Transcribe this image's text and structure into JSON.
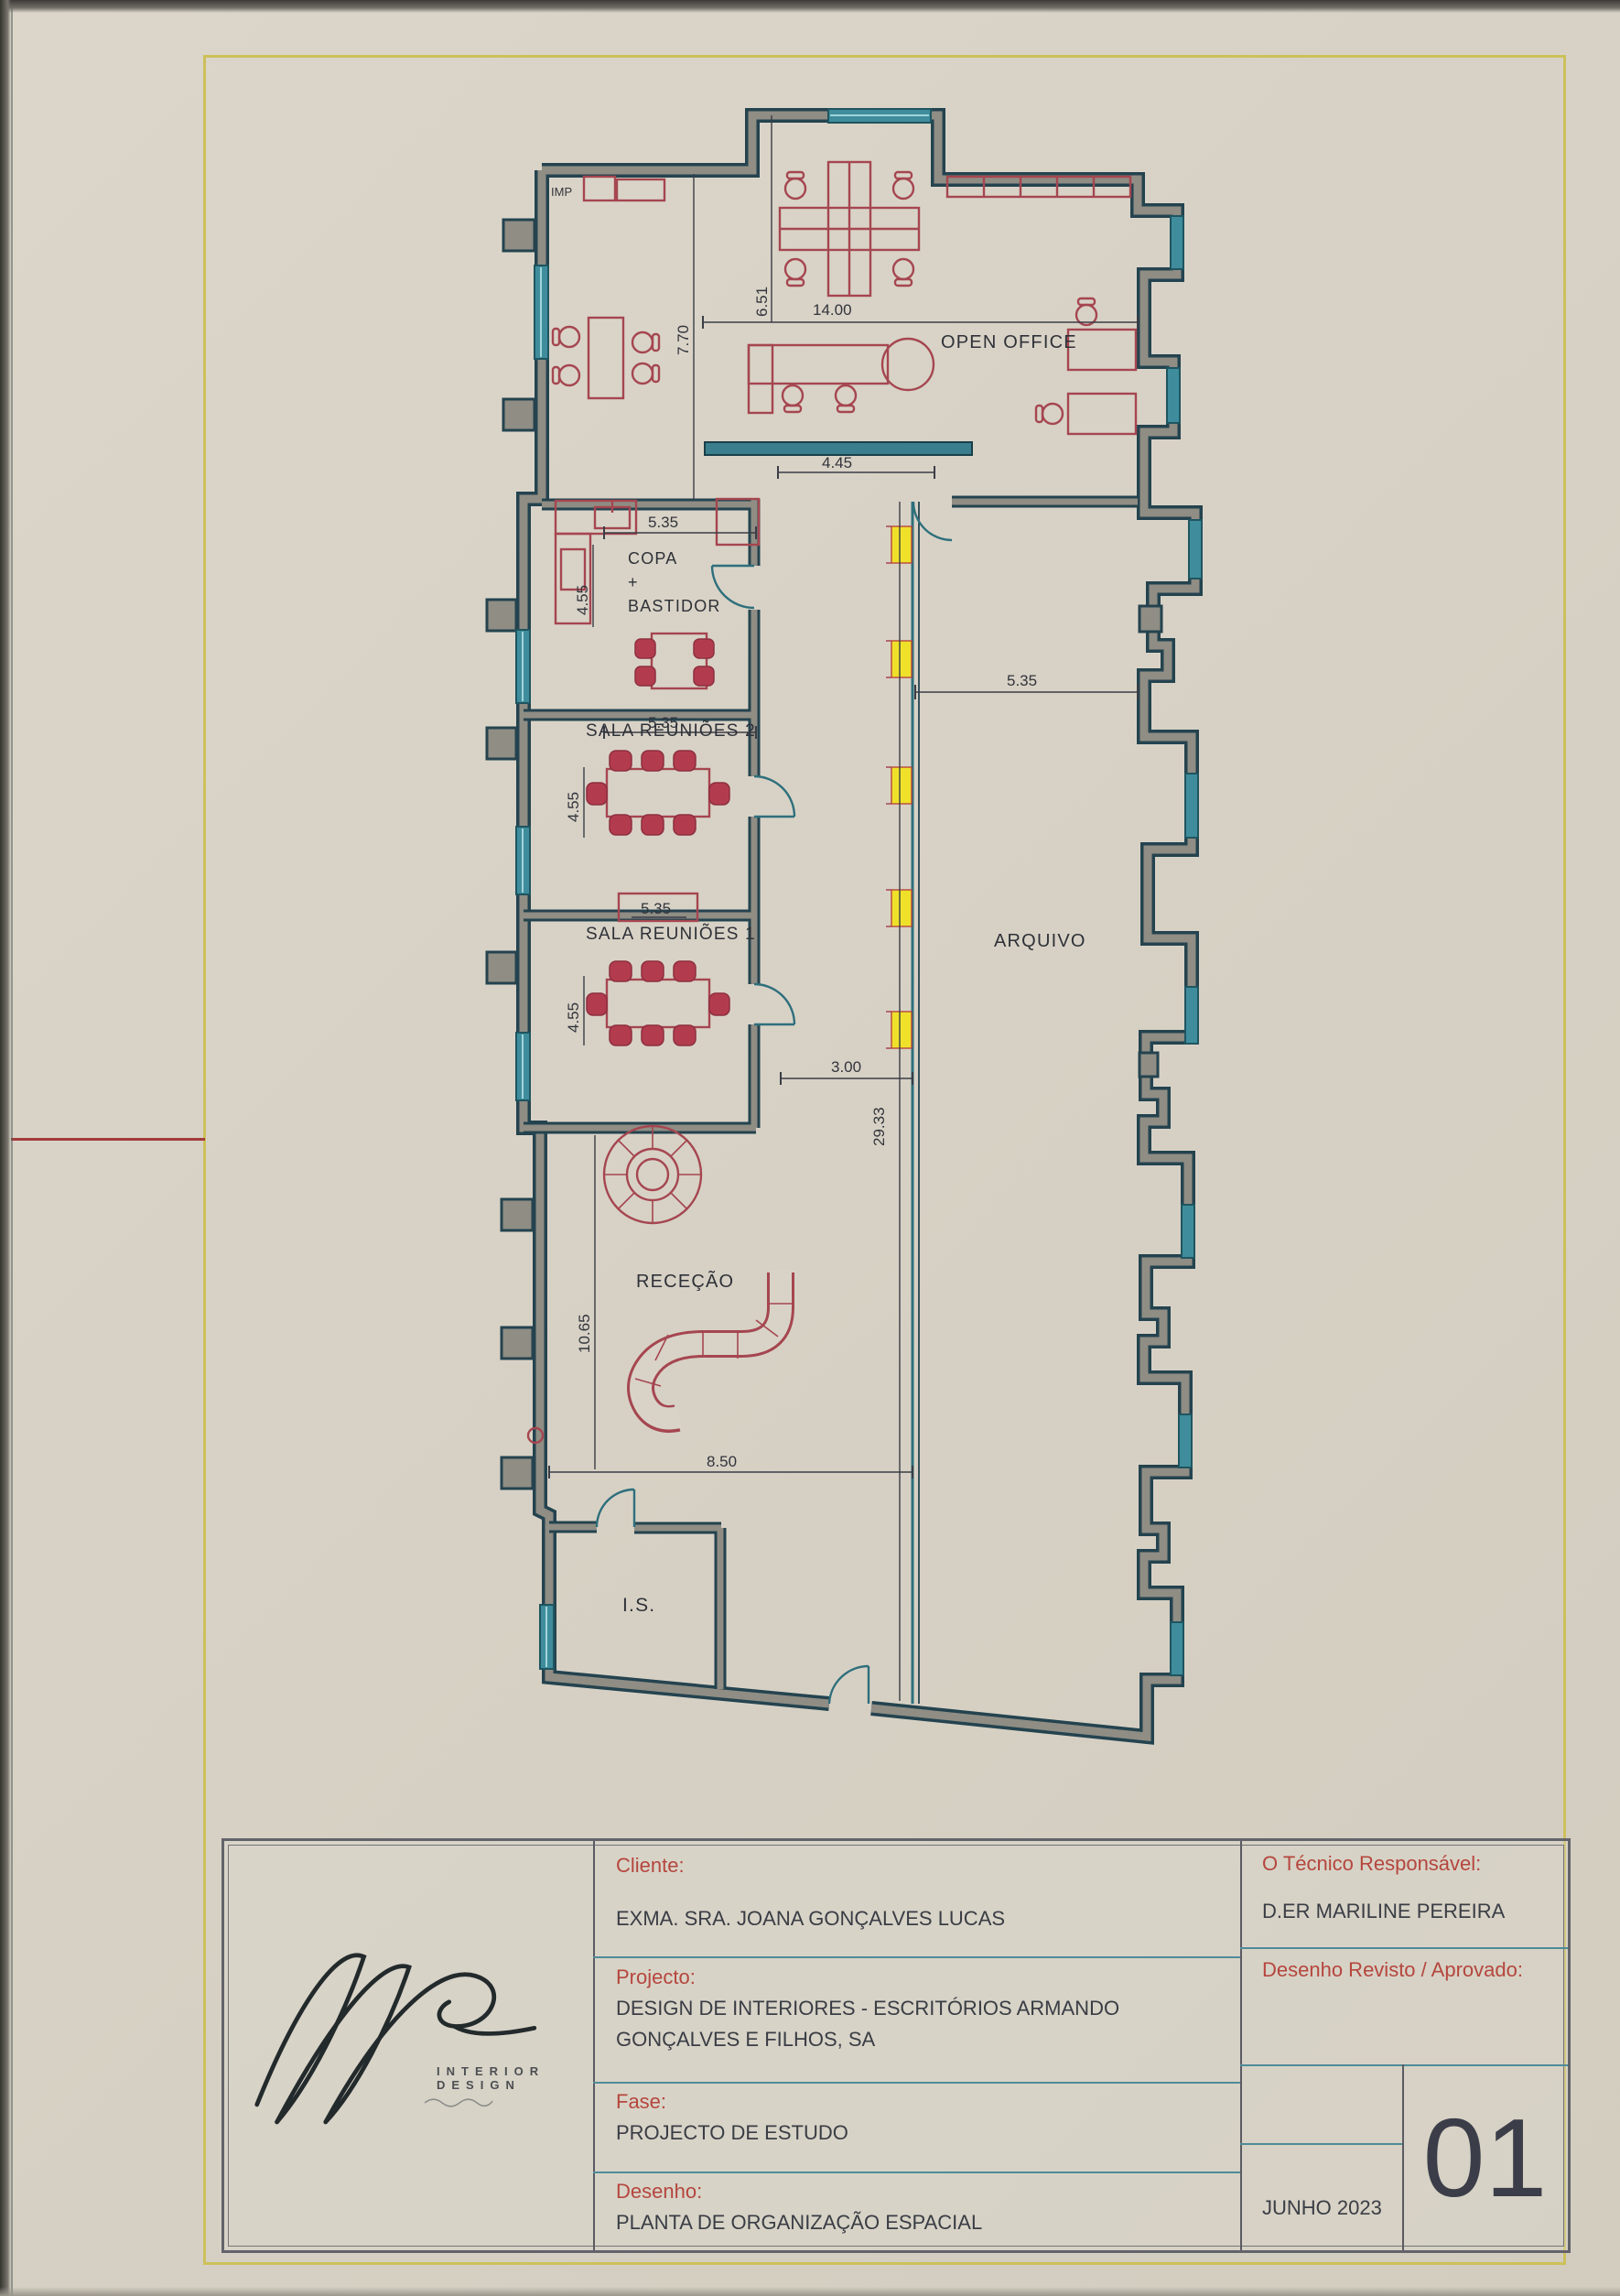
{
  "plan": {
    "rooms": {
      "imp": "IMP",
      "open_office": "OPEN OFFICE",
      "copa_1": "COPA",
      "copa_2": "+",
      "copa_3": "BASTIDOR",
      "sala_reunioes_2": "SALA REUNIÕES 2",
      "sala_reunioes_1": "SALA REUNIÕES 1",
      "arquivo": "ARQUIVO",
      "rececao": "RECEÇÃO",
      "is": "I.S."
    },
    "dims": {
      "top_width": "14.00",
      "top_height": "6.51",
      "left_height": "7.70",
      "partition": "4.45",
      "copa_w": "5.35",
      "copa_h": "4.55",
      "sala2_w": "5.35",
      "sala2_h": "4.55",
      "sala1_w": "5.35",
      "sala1_h": "4.55",
      "arquivo_w": "5.35",
      "corridor_w": "3.00",
      "corridor_len": "29.33",
      "rececao_h": "10.65",
      "bottom_w": "8.50"
    }
  },
  "titleblock": {
    "cliente_label": "Cliente:",
    "cliente_value": "EXMA. SRA. JOANA GONÇALVES LUCAS",
    "projecto_label": "Projecto:",
    "projecto_line1": "DESIGN DE INTERIORES - ESCRITÓRIOS ARMANDO",
    "projecto_line2": "GONÇALVES E FILHOS, SA",
    "fase_label": "Fase:",
    "fase_value": "PROJECTO DE ESTUDO",
    "desenho_label": "Desenho:",
    "desenho_value": "PLANTA DE ORGANIZAÇÃO ESPACIAL",
    "tecnico_label": "O Técnico Responsável:",
    "tecnico_value": "D.ER MARILINE PEREIRA",
    "revisto_label": "Desenho Revisto / Aprovado:",
    "date": "JUNHO 2023",
    "sheet_number": "01",
    "logo_subtitle": "INTERIOR DESIGN"
  },
  "colors": {
    "paper": "#d8d2c6",
    "wall_dark": "#24434f",
    "wall_fill": "#8f8d84",
    "window_teal": "#3f8d9c",
    "furniture_red": "#a54650",
    "chair_fill": "#b23c4e",
    "light_yellow": "#efe12a",
    "frame_yellow": "#ccc05a",
    "label_red": "#b5463e",
    "divider_teal": "#4f8b99",
    "text_dark": "#32343c"
  }
}
